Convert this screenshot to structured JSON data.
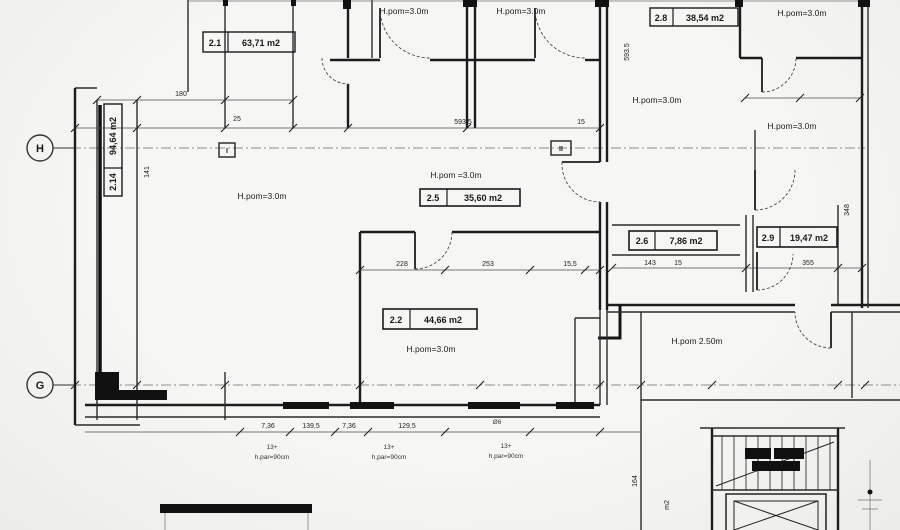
{
  "drawing": {
    "axes": {
      "h": "H",
      "g": "G",
      "section_i": "I",
      "section_ii": "II"
    },
    "rooms": {
      "r21": {
        "num": "2.1",
        "area": "63,71 m2"
      },
      "r214": {
        "num": "2.14",
        "area": "94,64 m2"
      },
      "r22": {
        "num": "2.2",
        "area": "44,66 m2"
      },
      "r25": {
        "num": "2.5",
        "area": "35,60 m2"
      },
      "r26": {
        "num": "2.6",
        "area": "7,86 m2"
      },
      "r28": {
        "num": "2.8",
        "area": "38,54 m2"
      },
      "r29": {
        "num": "2.9",
        "area": "19,47 m2"
      }
    },
    "heights": {
      "top_door_left": "H.pom=3.0m",
      "top_door_right": "H.pom=3.0m",
      "room_left": "H.pom=3.0m",
      "room_25": "H.pom =3.0m",
      "room_22": "H.pom=3.0m",
      "top_right_corner": "H.pom=3.0m",
      "right_a": "H.pom=3.0m",
      "right_b": "H.pom=3.0m",
      "corridor": "H.pom 2.50m"
    },
    "dims": {
      "top_180": "180",
      "top_25": "25",
      "top_main": "593.5",
      "top_15": "15",
      "mid_228": "228",
      "mid_253": "253",
      "mid_155": "15,5",
      "right_143": "143",
      "right_15": "15",
      "right_355": "355",
      "left_141": "141",
      "v_main": "593.5",
      "v_348": "348",
      "v_164": "164",
      "bot_a": "7,36",
      "bot_b": "139,5",
      "bot_c": "7,36",
      "bot_d": "129,5"
    },
    "notes": {
      "sill_height": "h.par=90cm",
      "count_13": "13+",
      "rebar": "Ø6",
      "m2": "m2"
    }
  }
}
